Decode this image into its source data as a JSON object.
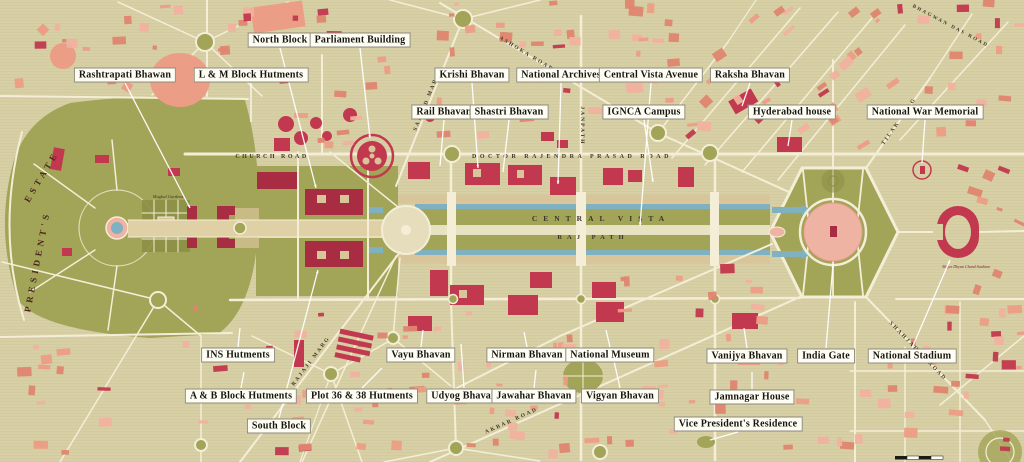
{
  "map": {
    "colors": {
      "bg": "#d8d0a5",
      "bg_line": "#c9c197",
      "road": "#f4eed6",
      "green": "#a2a458",
      "green_dark": "#8c9046",
      "water": "#7fb1c1",
      "path_tan": "#d8c59a",
      "road_mid": "#e9e2c2",
      "salmon": "#ec9d85",
      "salmon_dark": "#df8570",
      "salmon_light": "#f1b19e",
      "red": "#c2384e",
      "dark_red": "#a82c42",
      "plaza_pink": "#eeb3a2",
      "label_bg": "#fefdf4",
      "label_border": "#8f8b7c",
      "label_text": "#17150f",
      "street_text": "#3e3826",
      "estate_text": "#4a241f",
      "stadium_text": "#7a2030"
    },
    "labels": [
      {
        "id": "north-block",
        "text": "North Block",
        "x": 280,
        "y": 40,
        "tx": 316,
        "ty": 188
      },
      {
        "id": "parliament-building",
        "text": "Parliament Building",
        "x": 360,
        "y": 40,
        "tx": 370,
        "ty": 138
      },
      {
        "id": "rashtrapati-bhawan",
        "text": "Rashtrapati Bhawan",
        "x": 125,
        "y": 75,
        "tx": 190,
        "ty": 208
      },
      {
        "id": "l-m-block-hutments",
        "text": "L & M Block Hutments",
        "x": 251,
        "y": 75,
        "tx": 251,
        "ty": 122
      },
      {
        "id": "krishi-bhavan",
        "text": "Krishi Bhavan",
        "x": 472,
        "y": 75,
        "tx": 478,
        "ty": 168
      },
      {
        "id": "national-archives",
        "text": "National Archives",
        "x": 561,
        "y": 75,
        "tx": 558,
        "ty": 184
      },
      {
        "id": "central-vista-avenue",
        "text": "Central Vista Avenue",
        "x": 651,
        "y": 75,
        "tx": 640,
        "ty": 226
      },
      {
        "id": "raksha-bhavan",
        "text": "Raksha Bhavan",
        "x": 750,
        "y": 75,
        "tx": 742,
        "ty": 106
      },
      {
        "id": "rail-bhavan",
        "text": "Rail Bhavan",
        "x": 444,
        "y": 112,
        "tx": 440,
        "ty": 166
      },
      {
        "id": "shastri-bhavan",
        "text": "Shastri Bhavan",
        "x": 509,
        "y": 112,
        "tx": 503,
        "ty": 172
      },
      {
        "id": "ignca-campus",
        "text": "IGNCA Campus",
        "x": 644,
        "y": 112,
        "tx": 653,
        "ty": 182
      },
      {
        "id": "hyderabad-house",
        "text": "Hyderabad house",
        "x": 792,
        "y": 112,
        "tx": 788,
        "ty": 146
      },
      {
        "id": "national-war-memorial",
        "text": "National War Memorial",
        "x": 925,
        "y": 112,
        "tx": 922,
        "ty": 163
      },
      {
        "id": "ins-hutments",
        "text": "INS Hutments",
        "x": 238,
        "y": 355,
        "tx": 240,
        "ty": 328
      },
      {
        "id": "vayu-bhavan",
        "text": "Vayu Bhavan",
        "x": 421,
        "y": 355,
        "tx": 423,
        "ty": 330
      },
      {
        "id": "nirman-bhavan",
        "text": "Nirman Bhavan",
        "x": 527,
        "y": 355,
        "tx": 524,
        "ty": 332
      },
      {
        "id": "national-museum",
        "text": "National Museum",
        "x": 610,
        "y": 355,
        "tx": 606,
        "ty": 330
      },
      {
        "id": "vanijya-bhavan",
        "text": "Vanijya Bhavan",
        "x": 747,
        "y": 356,
        "tx": 744,
        "ty": 328
      },
      {
        "id": "india-gate",
        "text": "India Gate",
        "x": 826,
        "y": 356,
        "tx": 833,
        "ty": 264
      },
      {
        "id": "national-stadium",
        "text": "National Stadium",
        "x": 912,
        "y": 356,
        "tx": 950,
        "ty": 260
      },
      {
        "id": "a-b-block-hutments",
        "text": "A & B Block Hutments",
        "x": 241,
        "y": 396,
        "tx": 244,
        "ty": 372
      },
      {
        "id": "plot-36-38-hutments",
        "text": "Plot 36 & 38 Hutments",
        "x": 362,
        "y": 396,
        "tx": 382,
        "ty": 368
      },
      {
        "id": "udyog-bhavan",
        "text": "Udyog Bhavan",
        "x": 464,
        "y": 396,
        "tx": 461,
        "ty": 344
      },
      {
        "id": "jawahar-bhavan",
        "text": "Jawahar Bhavan",
        "x": 534,
        "y": 396,
        "tx": 536,
        "ty": 370
      },
      {
        "id": "vigyan-bhavan",
        "text": "Vigyan Bhavan",
        "x": 620,
        "y": 396,
        "tx": 612,
        "ty": 352
      },
      {
        "id": "jamnagar-house",
        "text": "Jamnagar House",
        "x": 752,
        "y": 397,
        "tx": 752,
        "ty": 372
      },
      {
        "id": "south-block",
        "text": "South Block",
        "x": 279,
        "y": 426,
        "tx": 318,
        "ty": 270
      },
      {
        "id": "vice-presidents-residence",
        "text": "Vice President's Residence",
        "x": 738,
        "y": 424,
        "tx": 710,
        "ty": 440
      }
    ],
    "streets": [
      {
        "id": "church-road",
        "text": "CHURCH ROAD",
        "x": 272,
        "y": 158,
        "rot": 0,
        "size": 6,
        "ls": 2.5,
        "c": "street"
      },
      {
        "id": "dr-rajendra-prasad-road",
        "text": "DOCTOR RAJENDRA PRASAD ROAD",
        "x": 572,
        "y": 158,
        "rot": 0,
        "size": 6,
        "ls": 3.5,
        "c": "street"
      },
      {
        "id": "central-vista",
        "text": "CENTRAL VISTA",
        "x": 601,
        "y": 221,
        "rot": 0,
        "size": 7.5,
        "ls": 6,
        "c": "street"
      },
      {
        "id": "raj-path",
        "text": "RAJ PATH",
        "x": 593,
        "y": 239,
        "rot": 0,
        "size": 6.5,
        "ls": 5,
        "c": "street"
      },
      {
        "id": "janpath",
        "text": "JANPATH",
        "x": 581,
        "y": 126,
        "rot": 90,
        "size": 5.5,
        "ls": 2,
        "c": "street"
      },
      {
        "id": "ashoka-road",
        "text": "ASHOKA ROAD",
        "x": 526,
        "y": 55,
        "rot": 31,
        "size": 5.5,
        "ls": 2,
        "c": "street"
      },
      {
        "id": "sansad-marg",
        "text": "SANSAD MARG",
        "x": 428,
        "y": 102,
        "rot": -68,
        "size": 5.5,
        "ls": 2,
        "c": "street"
      },
      {
        "id": "akbar-road",
        "text": "AKBAR ROAD",
        "x": 512,
        "y": 422,
        "rot": -24,
        "size": 5.5,
        "ls": 2,
        "c": "street"
      },
      {
        "id": "shahjahan-road",
        "text": "SHAHJAHAN ROAD",
        "x": 917,
        "y": 352,
        "rot": 46,
        "size": 5.5,
        "ls": 2,
        "c": "street"
      },
      {
        "id": "rajaji-marg",
        "text": "RAJAJI MARG",
        "x": 312,
        "y": 362,
        "rot": -53,
        "size": 5.5,
        "ls": 2,
        "c": "street"
      },
      {
        "id": "tilak-marg",
        "text": "TILAK MARG",
        "x": 900,
        "y": 122,
        "rot": -55,
        "size": 5.5,
        "ls": 2,
        "c": "street"
      },
      {
        "id": "bhagwan-das-road",
        "text": "BHAGWAN DAS ROAD",
        "x": 950,
        "y": 27,
        "rot": 28,
        "size": 5,
        "ls": 2,
        "c": "street"
      },
      {
        "id": "presidents",
        "text": "PRESIDENT'S",
        "x": 40,
        "y": 262,
        "rot": -79,
        "size": 9,
        "ls": 4,
        "c": "estate"
      },
      {
        "id": "estate",
        "text": "ESTATE",
        "x": 44,
        "y": 178,
        "rot": -59,
        "size": 9,
        "ls": 4,
        "c": "estate"
      }
    ],
    "small_labels": [
      {
        "id": "mughal-gardens",
        "text": "Mughal Gardens",
        "x": 168,
        "y": 198,
        "size": 4.5,
        "c": "street"
      },
      {
        "id": "dhyan-chand-stadium",
        "text": "Major Dhyan Chand Stadium",
        "x": 966,
        "y": 268,
        "size": 4,
        "c": "stadium"
      }
    ]
  }
}
